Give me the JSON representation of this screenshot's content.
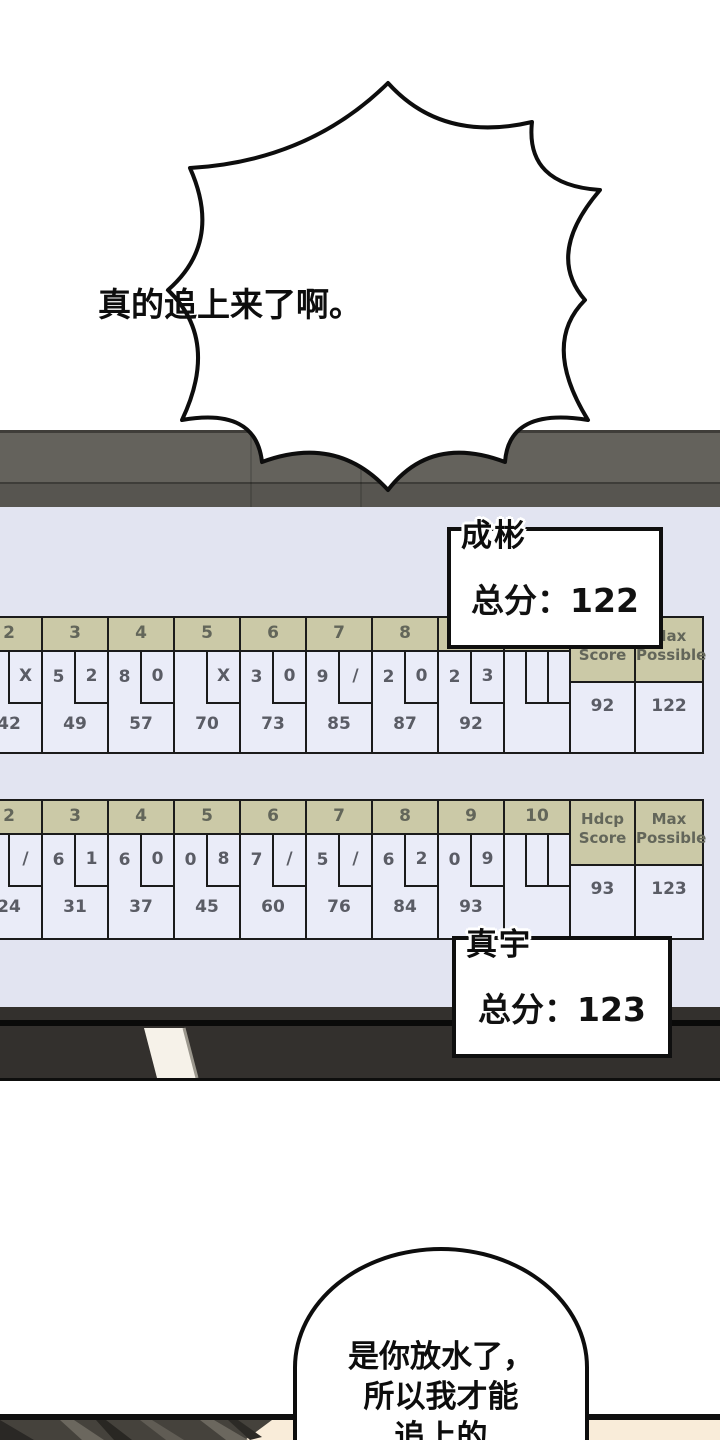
{
  "comic": {
    "burst_text": "真的追上来了啊。",
    "bottom_bubble_lines": [
      "是你放水了，",
      "所以我才能",
      "追上的"
    ]
  },
  "scoreboard": {
    "labels": {
      "hdcp1": "Hdcp",
      "hdcp2": "Score",
      "max1": "Max",
      "max2": "Possible"
    },
    "boards": [
      {
        "player": "成彬",
        "total_label": "总分：122",
        "hdcp_score": "92",
        "max_possible": "122",
        "frames": [
          {
            "num": "2",
            "b1": "",
            "b2": "X",
            "score": "42"
          },
          {
            "num": "3",
            "b1": "5",
            "b2": "2",
            "score": "49"
          },
          {
            "num": "4",
            "b1": "8",
            "b2": "0",
            "score": "57"
          },
          {
            "num": "5",
            "b1": "",
            "b2": "X",
            "score": "70"
          },
          {
            "num": "6",
            "b1": "3",
            "b2": "0",
            "score": "73"
          },
          {
            "num": "7",
            "b1": "9",
            "b2": "/",
            "score": "85"
          },
          {
            "num": "8",
            "b1": "2",
            "b2": "0",
            "score": "87"
          },
          {
            "num": "9",
            "b1": "2",
            "b2": "3",
            "score": "92"
          },
          {
            "num": "10",
            "b1": "",
            "b2": "",
            "score": ""
          }
        ]
      },
      {
        "player": "真宇",
        "total_label": "总分：123",
        "hdcp_score": "93",
        "max_possible": "123",
        "frames": [
          {
            "num": "2",
            "b1": "",
            "b2": "/",
            "score": "24"
          },
          {
            "num": "3",
            "b1": "6",
            "b2": "1",
            "score": "31"
          },
          {
            "num": "4",
            "b1": "6",
            "b2": "0",
            "score": "37"
          },
          {
            "num": "5",
            "b1": "0",
            "b2": "8",
            "score": "45"
          },
          {
            "num": "6",
            "b1": "7",
            "b2": "/",
            "score": "60"
          },
          {
            "num": "7",
            "b1": "5",
            "b2": "/",
            "score": "76"
          },
          {
            "num": "8",
            "b1": "6",
            "b2": "2",
            "score": "84"
          },
          {
            "num": "9",
            "b1": "0",
            "b2": "9",
            "score": "93"
          },
          {
            "num": "10",
            "b1": "",
            "b2": "",
            "score": ""
          }
        ]
      }
    ]
  },
  "colors": {
    "screen_bg": "#e2e4f1",
    "cell_bg": "#eaecf8",
    "header_tan": "#cbc9a7",
    "grid_border": "#1b1b1b",
    "number_text": "#5a5c65",
    "band_upper": "#64625c",
    "band_lower": "#575550",
    "bezel": "#33302d",
    "skin": "#f9ecd9",
    "hair": "#45423c"
  }
}
